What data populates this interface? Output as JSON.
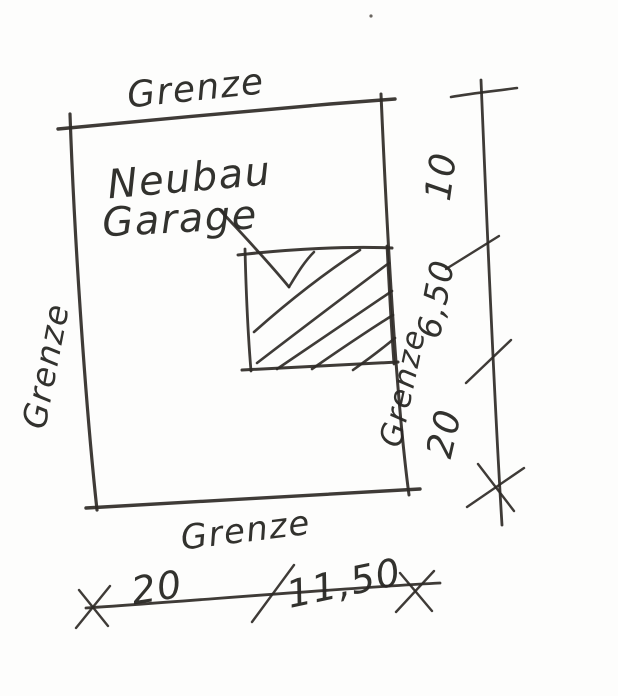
{
  "sketch": {
    "boundary_labels": {
      "top": "Grenze",
      "left": "Grenze",
      "right": "Grenze",
      "bottom": "Grenze"
    },
    "annotation": {
      "line1": "Neubau",
      "line2": "Garage"
    },
    "dimensions": {
      "right_top": "10",
      "right_middle": "6,50",
      "right_bottom": "20",
      "bottom_left": "20",
      "bottom_right": "11,50"
    },
    "colors": {
      "ink": "#2e2b28",
      "paper": "#fdfdfc"
    }
  }
}
